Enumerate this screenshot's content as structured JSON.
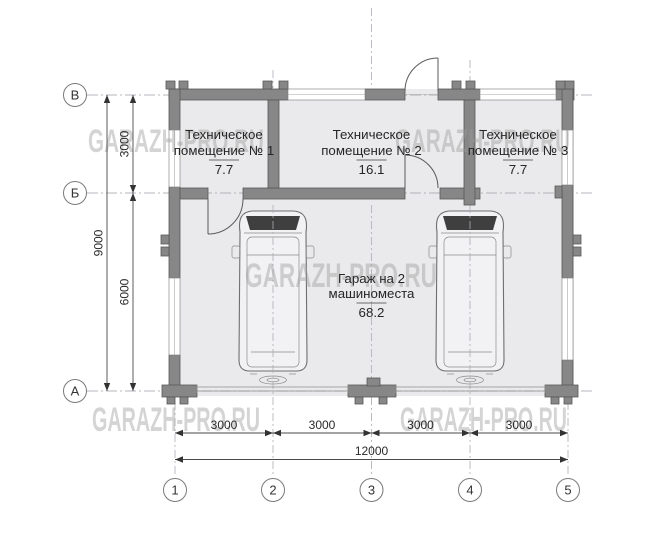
{
  "watermark": {
    "text": "GARAZH-PRO.RU",
    "color": "#9a9a9a"
  },
  "rooms": {
    "tech1": {
      "line1": "Техническое",
      "line2": "помещение № 1",
      "area": "7.7"
    },
    "tech2": {
      "line1": "Техническое",
      "line2": "помещение № 2",
      "area": "16.1"
    },
    "tech3": {
      "line1": "Техническое",
      "line2": "помещение № 3",
      "area": "7.7"
    },
    "garage": {
      "line1": "Гараж на 2",
      "line2": "машиноместа",
      "area": "68.2"
    }
  },
  "grid": {
    "rows": [
      "В",
      "Б",
      "А"
    ],
    "cols": [
      "1",
      "2",
      "3",
      "4",
      "5"
    ]
  },
  "dims": {
    "left_top": "3000",
    "left_bottom": "6000",
    "left_overall": "9000",
    "bottom_segments": [
      "3000",
      "3000",
      "3000",
      "3000"
    ],
    "bottom_overall": "12000"
  },
  "colors": {
    "wall": "#878787",
    "wall_stroke": "#575757",
    "floor": "#eaeaec",
    "dimension_line": "#4a4a4a",
    "grid_line": "#9aa0a8",
    "watermark": "#9a9a9a",
    "windshield": "#3f3f3f"
  }
}
